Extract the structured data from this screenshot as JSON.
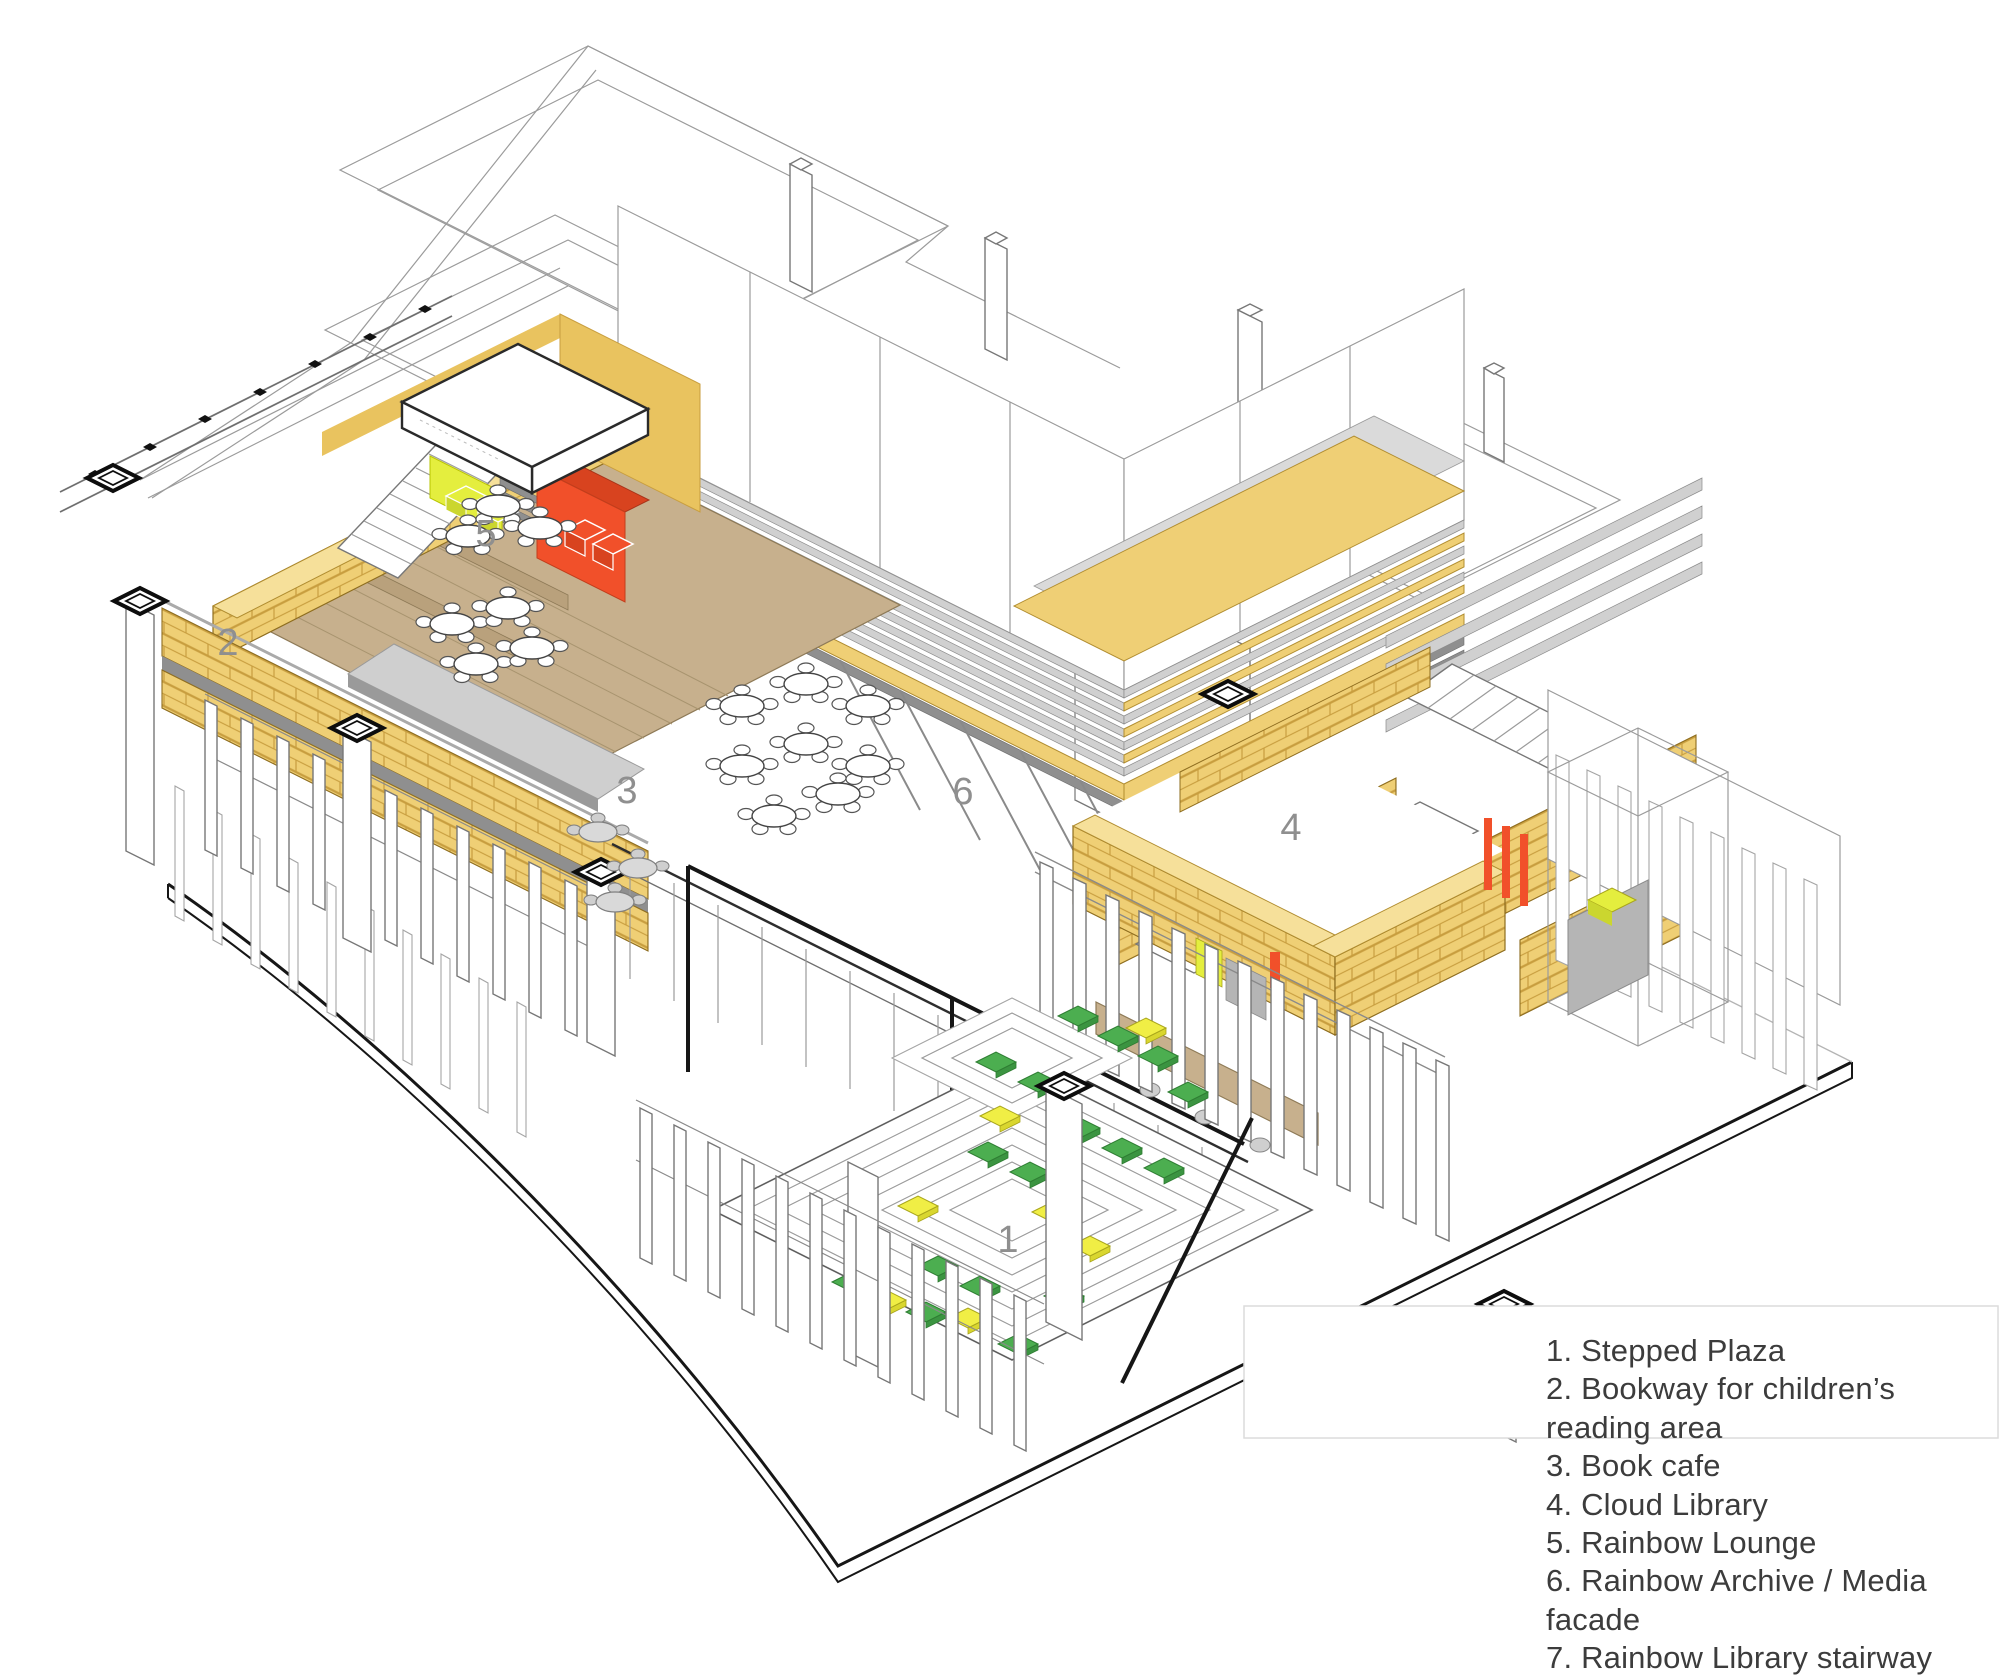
{
  "legend": {
    "items": [
      "1. Stepped Plaza",
      "2. Bookway for children’s reading area",
      "3. Book cafe",
      "4. Cloud Library",
      "5. Rainbow Lounge",
      "6. Rainbow Archive / Media facade",
      "7. Rainbow Library stairway"
    ]
  },
  "callouts": [
    {
      "number": "1",
      "area": "Stepped Plaza"
    },
    {
      "number": "2",
      "area": "Bookway for children’s reading area"
    },
    {
      "number": "3",
      "area": "Book cafe"
    },
    {
      "number": "4",
      "area": "Cloud Library"
    },
    {
      "number": "5",
      "area": "Rainbow Lounge"
    },
    {
      "number": "6",
      "area": "Rainbow Archive / Media facade"
    }
  ],
  "colors": {
    "shelf_yellow": "#EFCF75",
    "shelf_yellow_light": "#F6E09A",
    "shelf_joint": "#C89E3F",
    "floor_tan": "#C7B08D",
    "media_orange": "#F1502A",
    "lounge_chartreuse": "#E4EE3E",
    "cushion_green": "#4CAE50",
    "cushion_yellow": "#F0EE45",
    "louver_gray": "#D0D0D0",
    "outline_dark": "#1A1A1A",
    "callout_gray": "#8F8F8F"
  }
}
